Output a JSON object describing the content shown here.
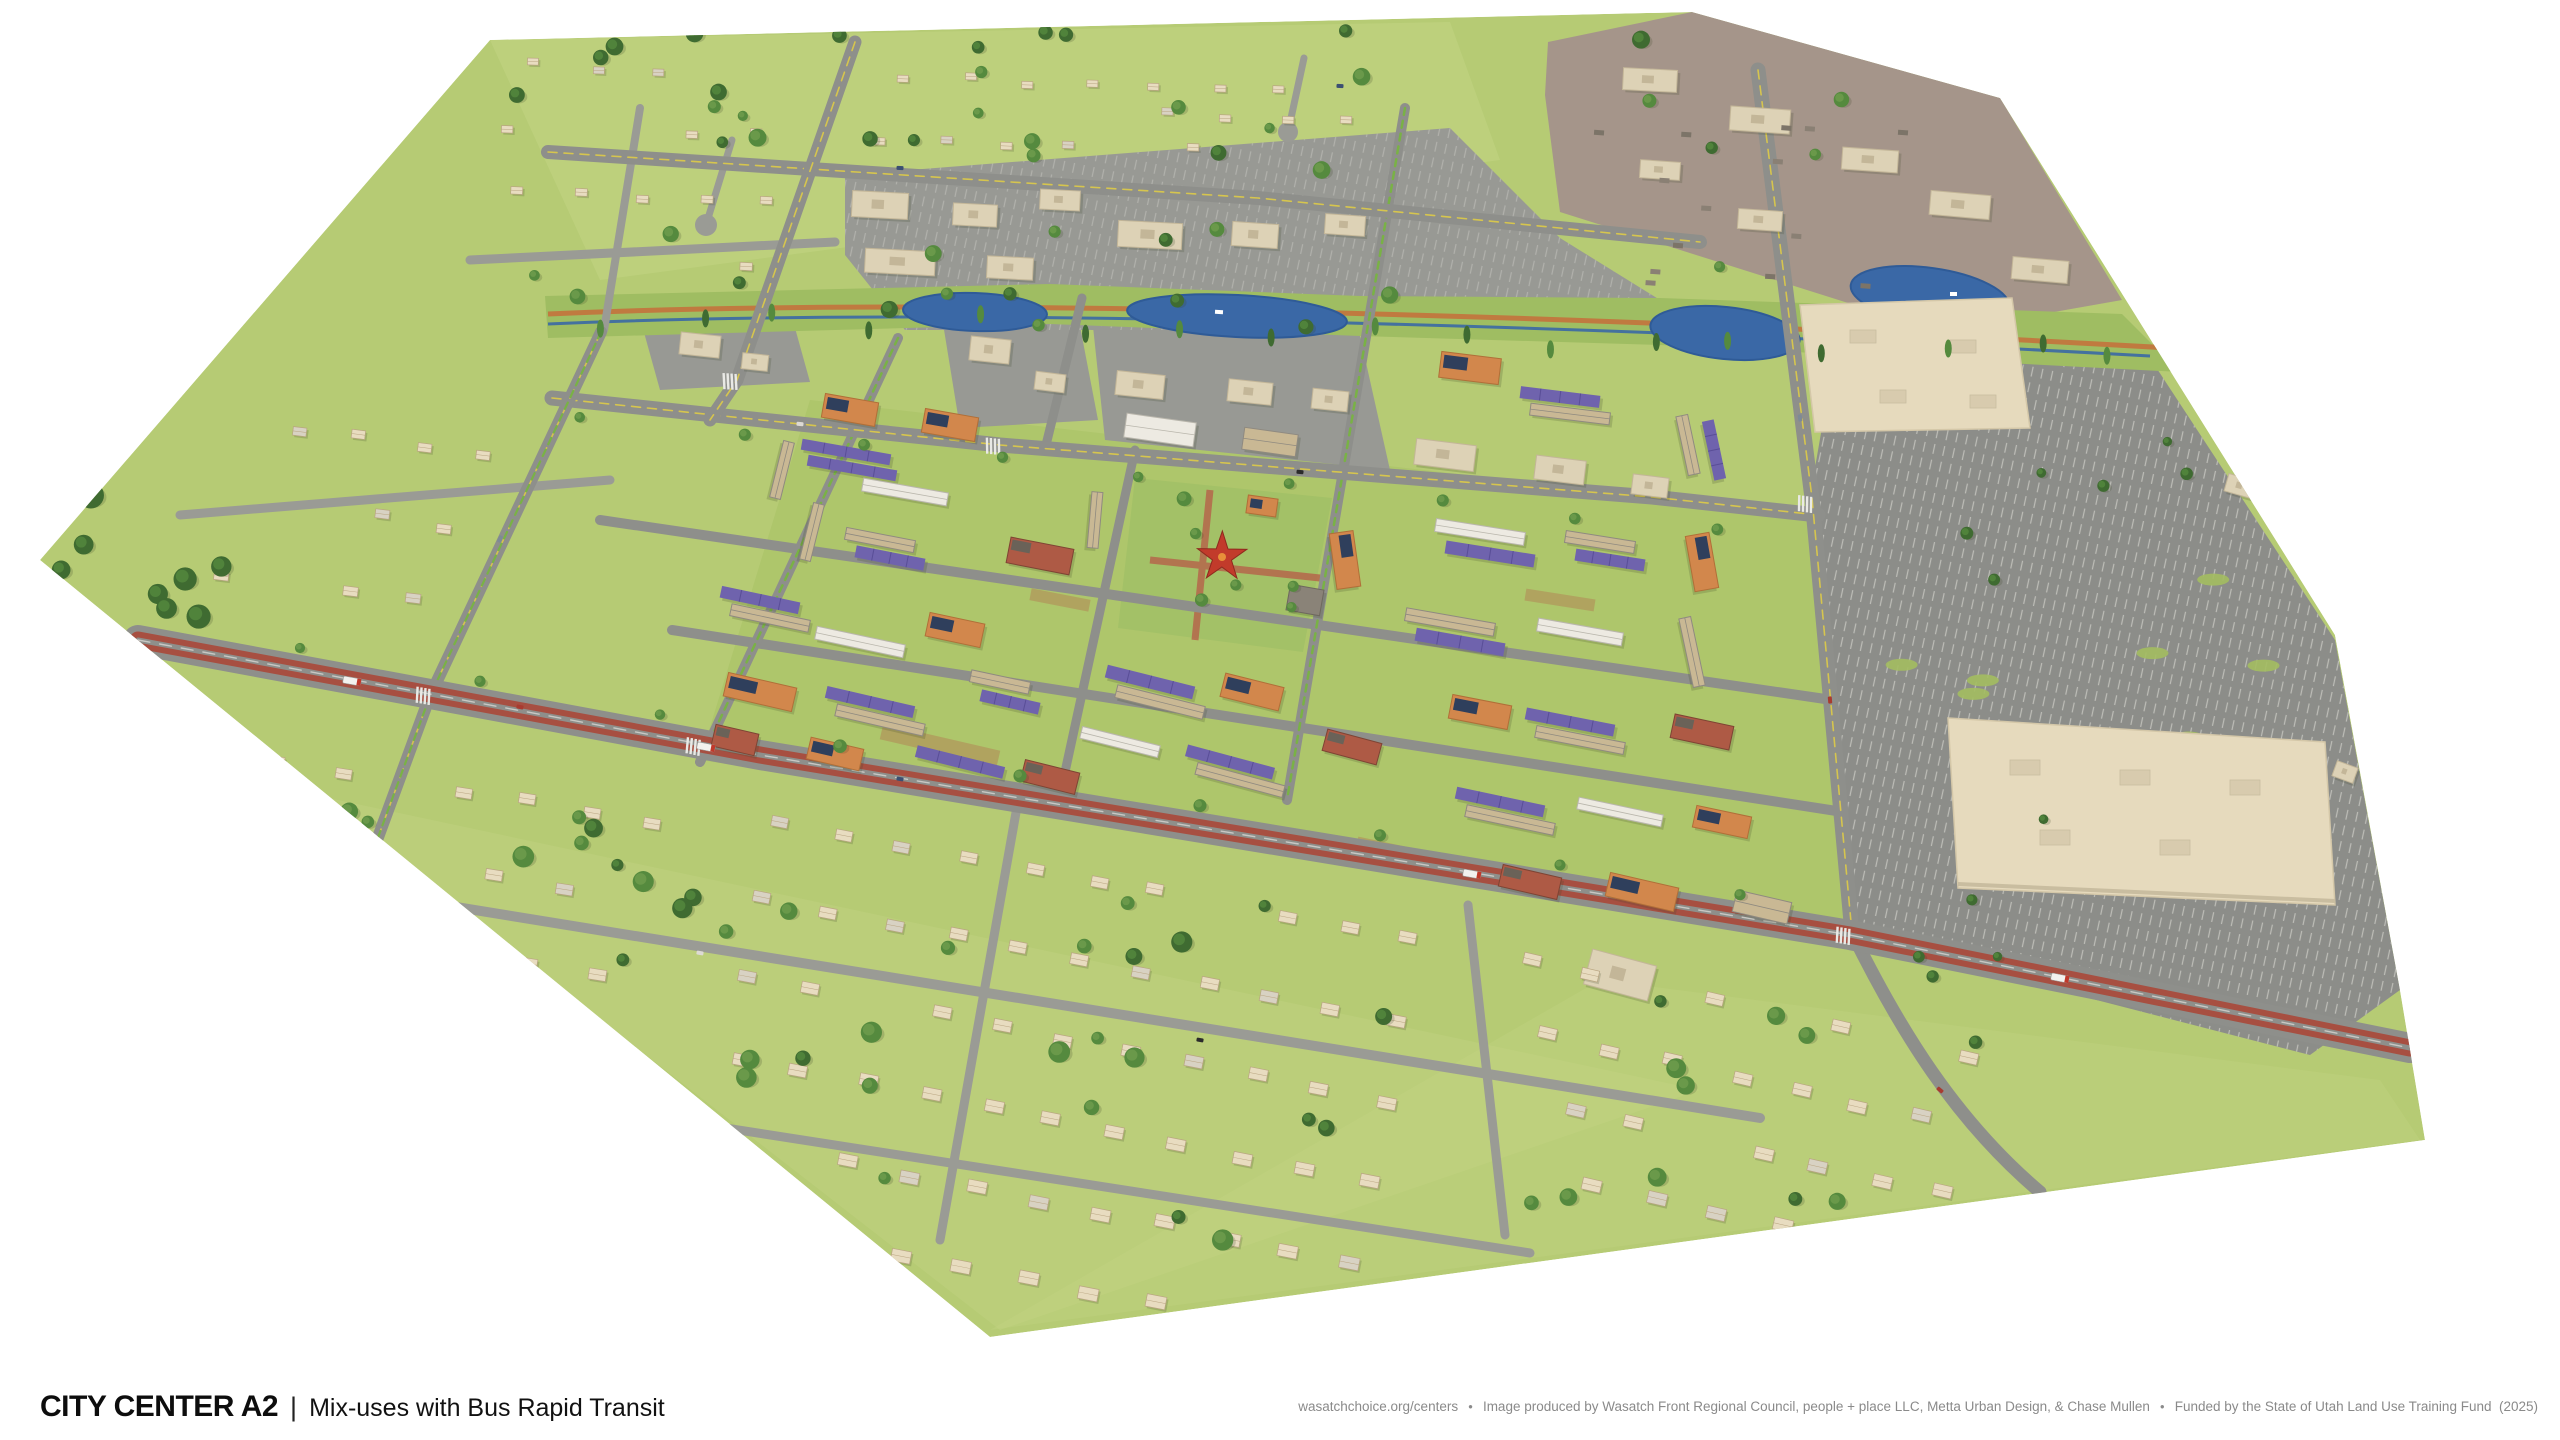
{
  "title": {
    "main": "CITY CENTER A2",
    "separator": "|",
    "subtitle": "Mix-uses with Bus Rapid Transit"
  },
  "attribution": {
    "website": "wasatchchoice.org/centers",
    "bullet": "●",
    "credit": "Image produced by Wasatch Front Regional Council, people + place LLC, Metta Urban Design, & Chase Mullen",
    "funding": "Funded by the State of Utah Land Use Training Fund  (2025)"
  },
  "palette": {
    "background": "#ffffff",
    "grass": "#b6cb74",
    "grassLight": "#c6d787",
    "grassDark": "#a3bd60",
    "creekBand": "#9fbd62",
    "road": "#8e8f8b",
    "roadMinor": "#9a9b95",
    "brtRed": "#a74f41",
    "laneYellow": "#d6c54e",
    "bikeGreen": "#79b245",
    "crosswalk": "#e9e9e5",
    "parking": "#8c8d89",
    "stall": "#c9c9c3",
    "water": "#3a68a6",
    "waterEdge": "#2f5b97",
    "trail": "#c07a40",
    "industrialGround": "#a5958a",
    "commercialGround": "#989994",
    "beige": "#ddd2b6",
    "beigeEdge": "#c3b698",
    "bigbox": "#e6dabd",
    "orange": "#d2874c",
    "orangeDark": "#b06f38",
    "solarPanel": "#2f3f5c",
    "purple": "#6f63ad",
    "purpleDark": "#594e97",
    "tan": "#c9b894",
    "tanRoof": "#8f8a80",
    "white": "#edeae2",
    "whiteRoof": "#b9b6ac",
    "brick": "#ae5a45",
    "brickDark": "#7e4434",
    "plaza": "#a3c167",
    "plazaPath": "#b5604a",
    "star": "#c23b2b",
    "house": "#e8dcc0",
    "houseLine": "#b9a581",
    "houseGray": "#d8d2c3",
    "treeDark": "#3f6b31",
    "tree": "#558a3e",
    "treeLight": "#6f9c4d",
    "shadow": "rgba(60,70,40,0.20)",
    "busBody": "#f2f1ee",
    "busAccent": "#c0392b"
  }
}
